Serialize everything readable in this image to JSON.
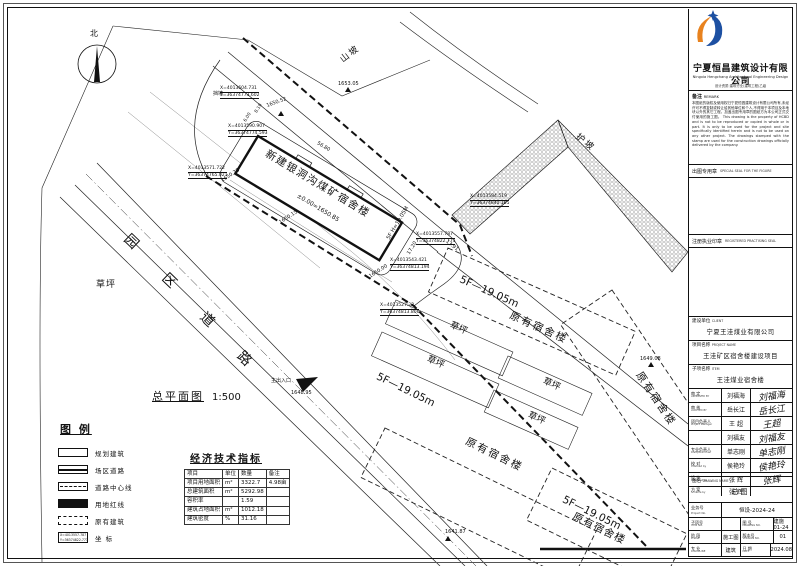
{
  "plan": {
    "title": "总平面图",
    "scale": "1:500",
    "north_label": "北"
  },
  "legend": {
    "title": "图 例",
    "items": [
      {
        "type": "planned",
        "label": "规划建筑"
      },
      {
        "type": "siteroad",
        "label": "场区道路"
      },
      {
        "type": "centerline",
        "label": "道路中心线"
      },
      {
        "type": "redline",
        "label": "用地红线"
      },
      {
        "type": "existing",
        "label": "原有建筑"
      },
      {
        "type": "coord",
        "label": "坐 标",
        "l1": "X=4013557.787",
        "l2": "Y=36374822.773"
      }
    ]
  },
  "econ": {
    "title": "经济技术指标",
    "headers": [
      "项目",
      "单位",
      "数量",
      "备注"
    ],
    "rows": [
      [
        "项目用地面积",
        "m²",
        "3322.7",
        "4.98亩"
      ],
      [
        "总建筑面积",
        "m²",
        "5292.98",
        ""
      ],
      [
        "容积率",
        "",
        "1.59",
        ""
      ],
      [
        "建筑占地面积",
        "m²",
        "1012.18",
        ""
      ],
      [
        "建筑密度",
        "%",
        "31.16",
        ""
      ]
    ]
  },
  "titleblock": {
    "company_cn": "宁夏恒昌建筑设计有限公司",
    "company_en": "Ningxia Hengchang Architectural Engineering Design Co., Ltd",
    "company_sub": "设计资质:建筑行业(建筑工程)乙级",
    "remark_label": "备注",
    "remark_label_en": "REMARK",
    "remark_cn": "本图纸的版权及使用权归宁夏恒昌建筑设计有限公司所有,未经许可不得复制或转让给其他单位和个人,不得用于本项目及本地块以外的其它工程。加盖出图专用章的图纸方为本公司正式交付使用的施工图。",
    "remark_en": "This drawing is the property of HCBD and is not to be reproduced or copied in whole or in part. It is only to be used for the project and site specifically identified herein and is not to be used on any other project. The drawings stamped with the stamp are used for the construction drawings officially delivered by the company.",
    "seal1_cn": "出图专用章",
    "seal1_en": "SPECIAL SEAL FOR THE FIGURE",
    "seal2_cn": "注册执业印章",
    "seal2_en": "REGISTERED PRACTISING SEAL",
    "client_label": "建设单位",
    "client_label_en": "CLIENT",
    "client": "宁夏王洼煤业有限公司",
    "project_label": "项目名称",
    "project_label_en": "PROJECT NAME",
    "project": "王洼矿区宿舍楼建设项目",
    "item_label": "子项名称",
    "item_label_en": "ITEM",
    "item": "王洼煤业宿舍楼",
    "signers": [
      {
        "role": "审 定",
        "role_en": "APPROVED BY",
        "name": "刘福海",
        "sig": "刘福海"
      },
      {
        "role": "审 核",
        "role_en": "AUDITED BY",
        "name": "岳长江",
        "sig": "岳长江"
      },
      {
        "role": "项目负责人",
        "role_en": "Project Manager",
        "name": "王 超",
        "sig": "王超"
      },
      {
        "role": "",
        "role_en": "",
        "name": "刘福友",
        "sig": "刘福友"
      },
      {
        "role": "专业负责人",
        "role_en": "Discipline Chief",
        "name": "单志刚",
        "sig": "单志刚"
      },
      {
        "role": "校 对",
        "role_en": "Checked by",
        "name": "侯艳玲",
        "sig": "侯艳玲"
      },
      {
        "role": "设 计",
        "role_en": "Designed by",
        "name": "张 辉",
        "sig": "张辉"
      },
      {
        "role": "方 案",
        "role_en": "Scheme by",
        "name": "张 辉",
        "sig": ""
      }
    ],
    "drawing_name_label": "图名",
    "drawing_name_label_en": "DRAWING NAME",
    "drawing_name": "总图",
    "project_no_label": "业务号",
    "project_no_label_en": "Project No.",
    "project_no": "恒设-2024-24",
    "grid": [
      {
        "l": "子项号",
        "le": "ITEM NO.",
        "v": ""
      },
      {
        "l": "图 号",
        "le": "DRAWING NO.",
        "v": "建施01-24"
      },
      {
        "l": "阶 段",
        "le": "PHASE",
        "v": "施工图"
      },
      {
        "l": "版本号",
        "le": "VERSION NO.",
        "v": "01"
      },
      {
        "l": "专 业",
        "le": "DISCIPLINE",
        "v": "建筑"
      },
      {
        "l": "日 期",
        "le": "DATE",
        "v": "2024.08"
      }
    ]
  },
  "colors": {
    "logo_blue": "#1d50a2",
    "logo_orange": "#e8821e",
    "line": "#111111"
  },
  "annotations": [
    {
      "t": "北",
      "x": 90,
      "y": 30,
      "s": 8
    },
    {
      "t": "山坡",
      "x": 342,
      "y": 57,
      "r": -38,
      "s": 9,
      "ls": 2
    },
    {
      "t": "1653.05",
      "x": 338,
      "y": 82,
      "s": 5
    },
    {
      "t": "挡墙",
      "x": 213,
      "y": 92,
      "s": 5
    },
    {
      "t": "护坡",
      "x": 576,
      "y": 132,
      "r": 38,
      "s": 9,
      "ls": 2
    },
    {
      "t": "园",
      "x": 126,
      "y": 230,
      "r": 44,
      "s": 14
    },
    {
      "t": "区",
      "x": 164,
      "y": 269,
      "r": 44,
      "s": 14
    },
    {
      "t": "道",
      "x": 202,
      "y": 308,
      "r": 44,
      "s": 14
    },
    {
      "t": "路",
      "x": 239,
      "y": 347,
      "r": 44,
      "s": 14
    },
    {
      "t": "草坪",
      "x": 96,
      "y": 281,
      "s": 9,
      "ls": 1
    },
    {
      "t": "新建银洞沟煤矿宿舍楼",
      "x": 266,
      "y": 148,
      "r": 31,
      "s": 10.5,
      "ls": 1.5
    },
    {
      "t": "±0.00=1650.85",
      "x": 297,
      "y": 193,
      "r": 31,
      "s": 6
    },
    {
      "t": "5F H=19.05M",
      "x": 389,
      "y": 237,
      "r": -59,
      "s": 5.5
    },
    {
      "t": "5F—19.05m",
      "x": 460,
      "y": 274,
      "r": 24,
      "s": 10.5
    },
    {
      "t": "原有宿舍楼",
      "x": 510,
      "y": 310,
      "r": 24,
      "s": 10.5,
      "ls": 2
    },
    {
      "t": "5F—19.05m",
      "x": 377,
      "y": 371,
      "r": 26,
      "s": 10.5
    },
    {
      "t": "原有宿舍楼",
      "x": 466,
      "y": 436,
      "r": 26,
      "s": 10.5,
      "ls": 2
    },
    {
      "t": "原有宿舍楼",
      "x": 638,
      "y": 368,
      "r": 56,
      "s": 10.5,
      "ls": 2
    },
    {
      "t": "5F—19.05m",
      "x": 563,
      "y": 494,
      "r": 26,
      "s": 10.5
    },
    {
      "t": "原有宿舍楼",
      "x": 573,
      "y": 511,
      "r": 26,
      "s": 10.5,
      "ls": 1
    },
    {
      "t": "主出入口",
      "x": 271,
      "y": 379,
      "s": 5
    },
    {
      "t": "1648.95",
      "x": 291,
      "y": 391,
      "s": 5
    },
    {
      "t": "1641.87",
      "x": 445,
      "y": 530,
      "s": 5
    },
    {
      "t": "1649.08",
      "x": 640,
      "y": 357,
      "s": 5
    },
    {
      "t": "1650.52",
      "x": 267,
      "y": 104,
      "r": -20,
      "s": 5
    },
    {
      "t": "1650.28",
      "x": 222,
      "y": 179,
      "r": -33,
      "s": 5
    },
    {
      "t": "1650.15",
      "x": 280,
      "y": 221,
      "r": -33,
      "s": 5
    },
    {
      "t": "1650.00",
      "x": 370,
      "y": 275,
      "r": -33,
      "s": 5
    },
    {
      "t": "56.80",
      "x": 317,
      "y": 141,
      "r": 31,
      "s": 5
    },
    {
      "t": "17.20",
      "x": 409,
      "y": 252,
      "r": -59,
      "s": 5
    },
    {
      "t": "13.91",
      "x": 446,
      "y": 239,
      "r": 39,
      "s": 5
    },
    {
      "t": "6.00",
      "x": 246,
      "y": 120,
      "r": -59,
      "s": 4.5
    },
    {
      "t": "8.10",
      "x": 257,
      "y": 111,
      "r": -59,
      "s": 4.5
    },
    {
      "t": "总平面图",
      "x": 152,
      "y": 391,
      "s": 11,
      "u": 1,
      "ls": 2
    },
    {
      "t": "1:500",
      "x": 212,
      "y": 393,
      "s": 10
    },
    {
      "t": "图 例",
      "x": 60,
      "y": 424,
      "s": 11,
      "b": 1,
      "u": 1,
      "ls": 2
    },
    {
      "t": "经济技术指标",
      "x": 190,
      "y": 455,
      "s": 10,
      "b": 1,
      "u": 1,
      "ls": 2
    },
    {
      "t": "草坪",
      "x": 450,
      "y": 321,
      "r": 24,
      "s": 9
    },
    {
      "t": "草坪",
      "x": 427,
      "y": 355,
      "r": 24,
      "s": 9
    },
    {
      "t": "草坪",
      "x": 543,
      "y": 377,
      "r": 24,
      "s": 9
    },
    {
      "t": "草坪",
      "x": 528,
      "y": 411,
      "r": 24,
      "s": 9
    }
  ],
  "coordinates": [
    {
      "x": 220,
      "y": 86,
      "l1": "X=4013604.731",
      "l2": "Y=36374773.602"
    },
    {
      "x": 228,
      "y": 124,
      "l1": "X=4013590.907",
      "l2": "Y=36374774.593"
    },
    {
      "x": 188,
      "y": 166,
      "l1": "X=4013571.722",
      "l2": "Y=36374765.021"
    },
    {
      "x": 390,
      "y": 258,
      "l1": "X=4013543.421",
      "l2": "Y=36374813.194"
    },
    {
      "x": 416,
      "y": 232,
      "l1": "X=4013557.787",
      "l2": "Y=36374822.773"
    },
    {
      "x": 470,
      "y": 194,
      "l1": "X=4013584.519",
      "l2": "Y=36374840.105"
    },
    {
      "x": 380,
      "y": 303,
      "l1": "X=4013527.22",
      "l2": "Y=36374813.806"
    }
  ]
}
